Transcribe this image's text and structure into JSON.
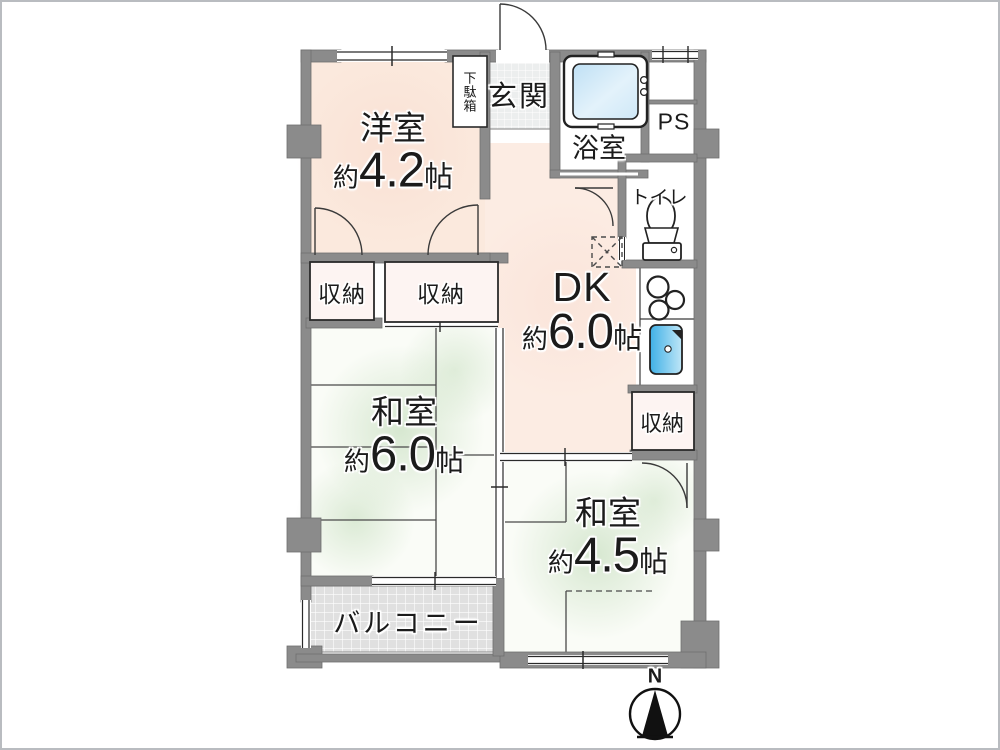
{
  "plan": {
    "type": "japanese-apartment-floor-plan",
    "rooms": {
      "youshitsu": {
        "name": "洋室",
        "approx": "約",
        "size": "4.2",
        "unit": "帖"
      },
      "dk": {
        "name": "DK",
        "approx": "約",
        "size": "6.0",
        "unit": "帖"
      },
      "washitsu6": {
        "name": "和室",
        "approx": "約",
        "size": "6.0",
        "unit": "帖"
      },
      "washitsu45": {
        "name": "和室",
        "approx": "約",
        "size": "4.5",
        "unit": "帖"
      }
    },
    "labels": {
      "genkan": "玄関",
      "getabako": "下駄箱",
      "bathroom": "浴室",
      "ps": "PS",
      "toilet": "トイレ",
      "storage": "収納",
      "balcony": "バルコニー",
      "compass_north": "N"
    },
    "colors": {
      "wall_gray": "#8b8b8b",
      "room_peach": "#fbe9dd",
      "dk_peach": "#fcece3",
      "tatami_green_tint": "#cfe3c9",
      "storage_pink": "#fdf4f2",
      "balcony_tile": "#e0e0e0",
      "genkan_tile": "#eceeee",
      "bathtub_blue": "#cfe8f7",
      "sink_blue": "#45b5e8",
      "line_black": "#2a2a2a"
    }
  }
}
